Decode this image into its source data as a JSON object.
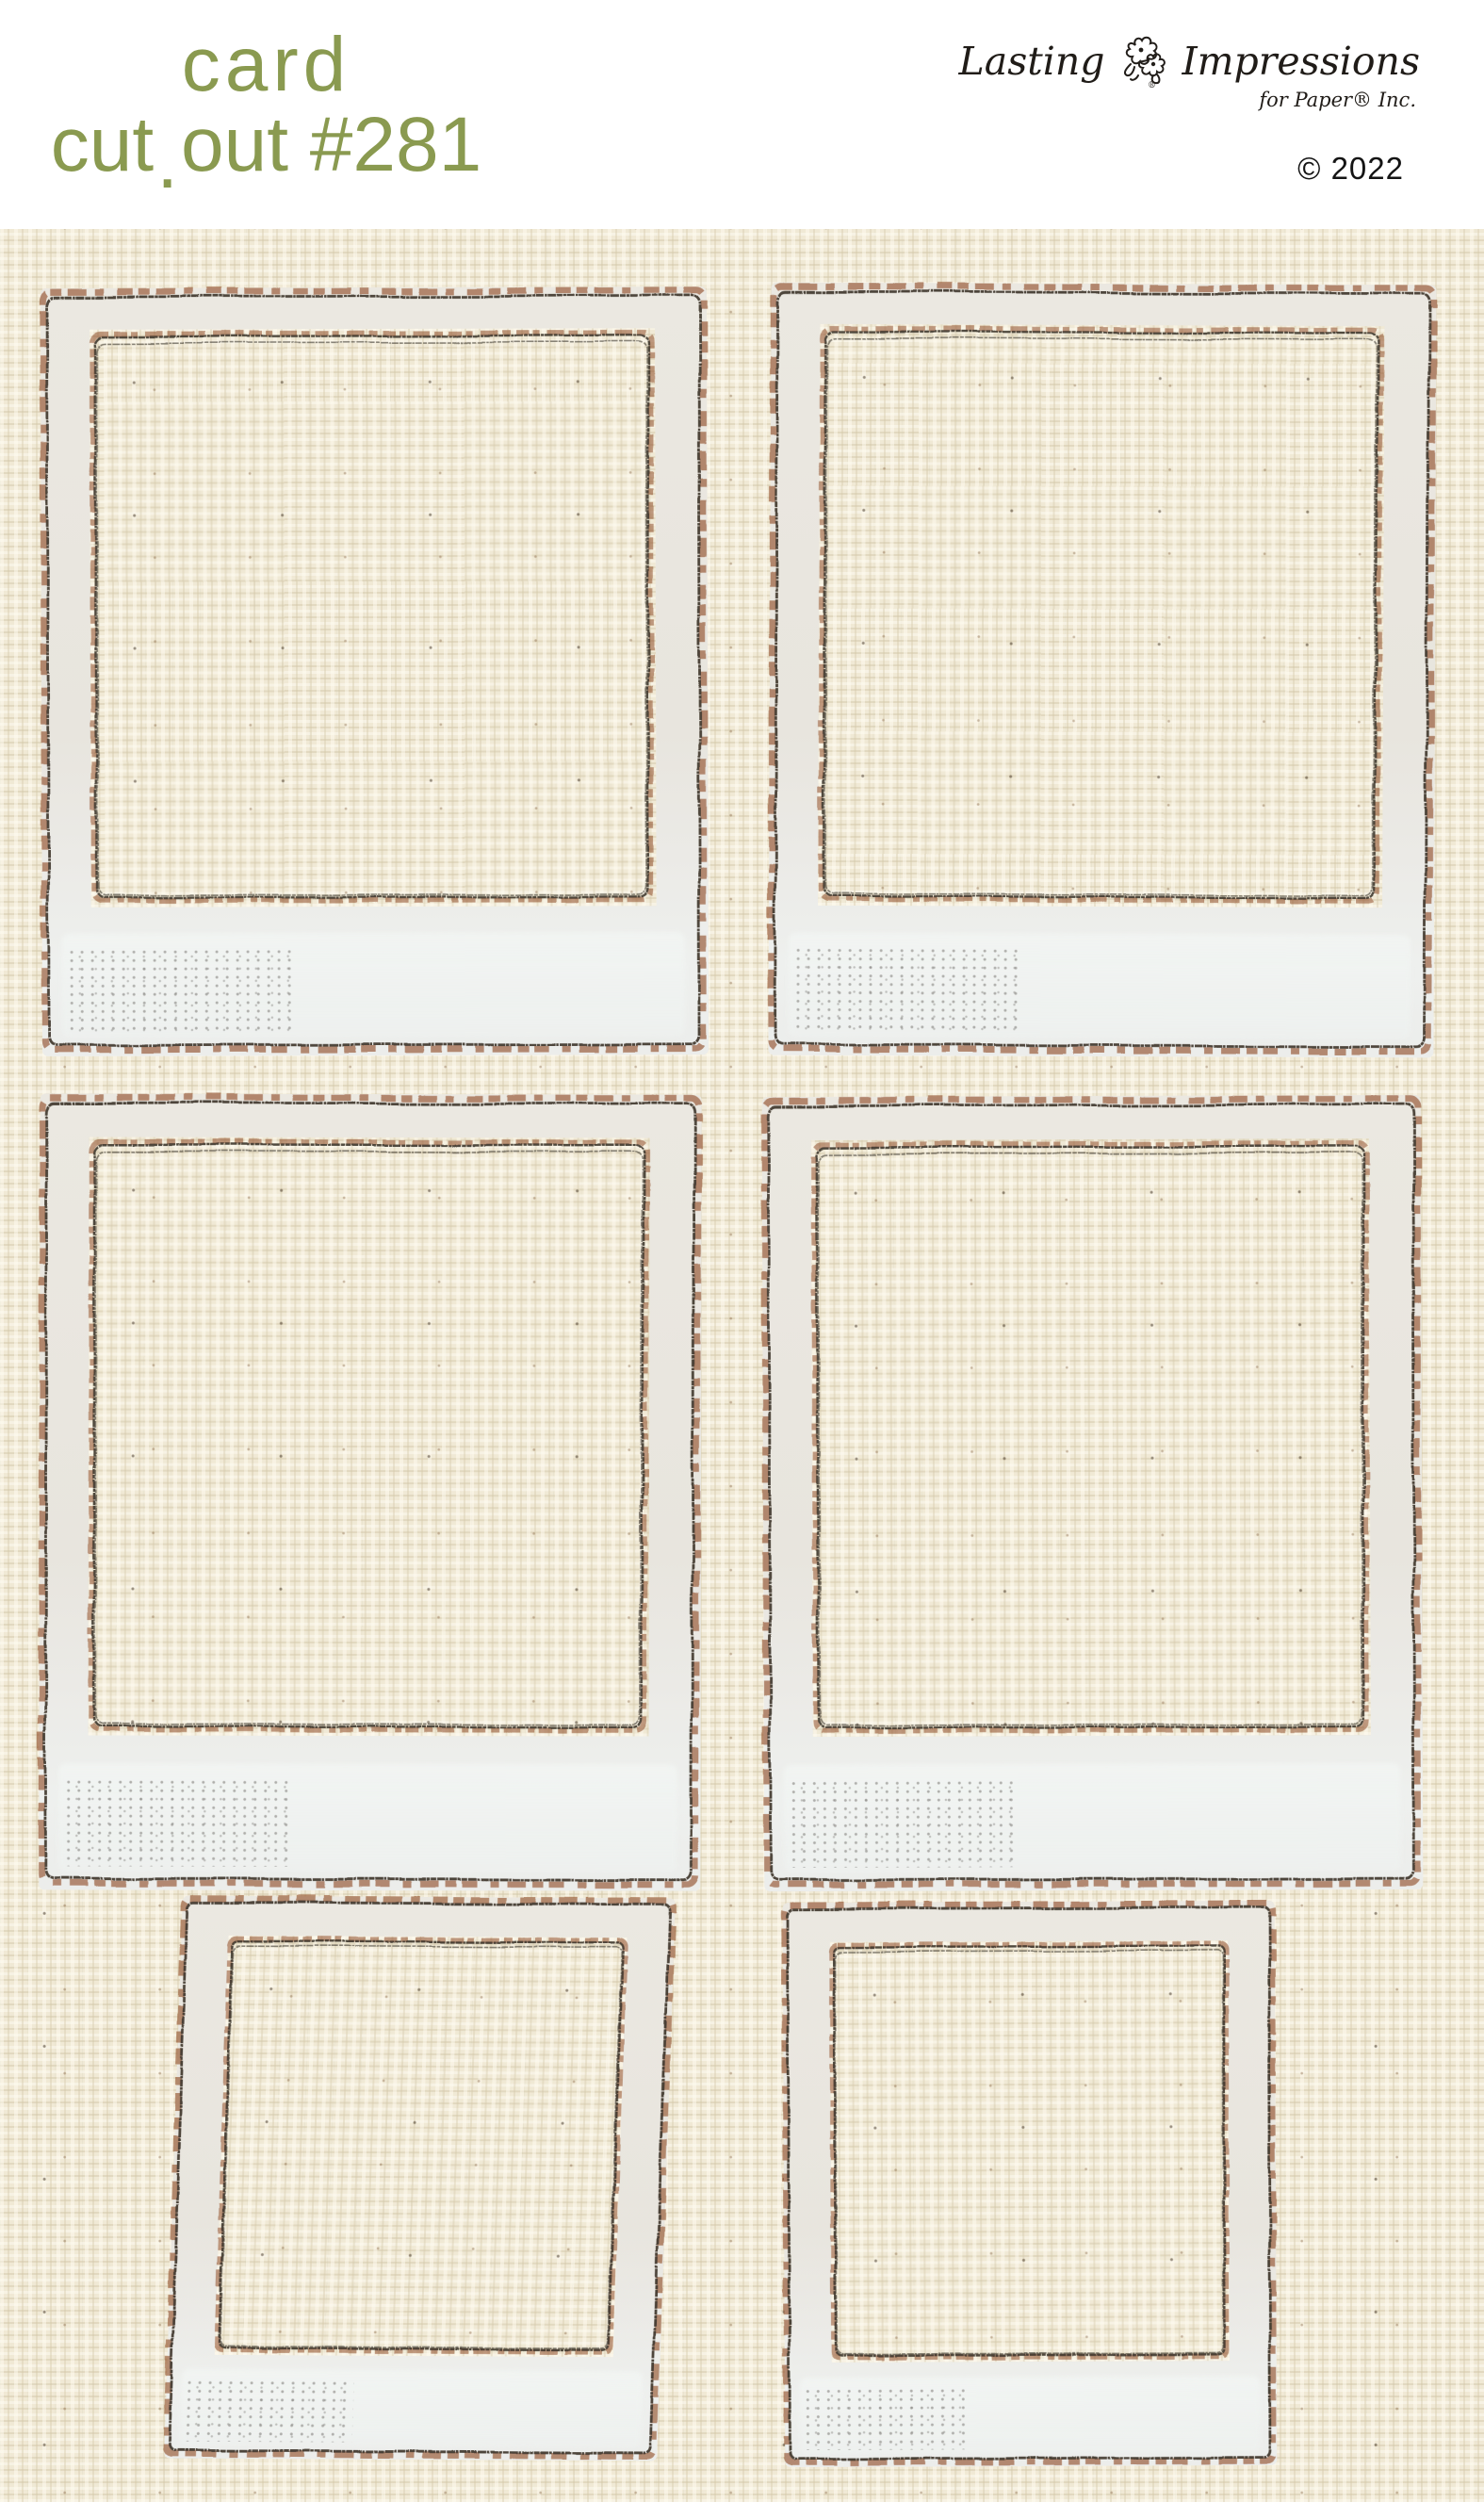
{
  "page": {
    "title_line1": "card",
    "subtitle_word": "cut",
    "subtitle_dot": ".",
    "subtitle_rest": "out #281",
    "copyright": "© 2022"
  },
  "brand": {
    "word1": "Lasting",
    "word2": "Impressions",
    "tagline": "for Paper® Inc.",
    "registered_mark": "®"
  },
  "icons": {
    "brand_flower": "flower-doodle"
  },
  "colors": {
    "title_green": "#8a9a50",
    "logo_ink": "#201c18",
    "header_bg": "#ffffff",
    "canvas_base": "#f0e9d5",
    "canvas_light": "#faf5e5",
    "canvas_shade": "#ded4b8",
    "sketch_charcoal": "#3f372d",
    "sketch_rust": "#8f4d28",
    "polaroid_band": "#eae7e0",
    "polaroid_bottom_band": "#eff1ef"
  },
  "sheet": {
    "frames": [
      {
        "id": "f1"
      },
      {
        "id": "f2"
      },
      {
        "id": "f3"
      },
      {
        "id": "f4"
      },
      {
        "id": "f5"
      },
      {
        "id": "f6"
      }
    ]
  }
}
